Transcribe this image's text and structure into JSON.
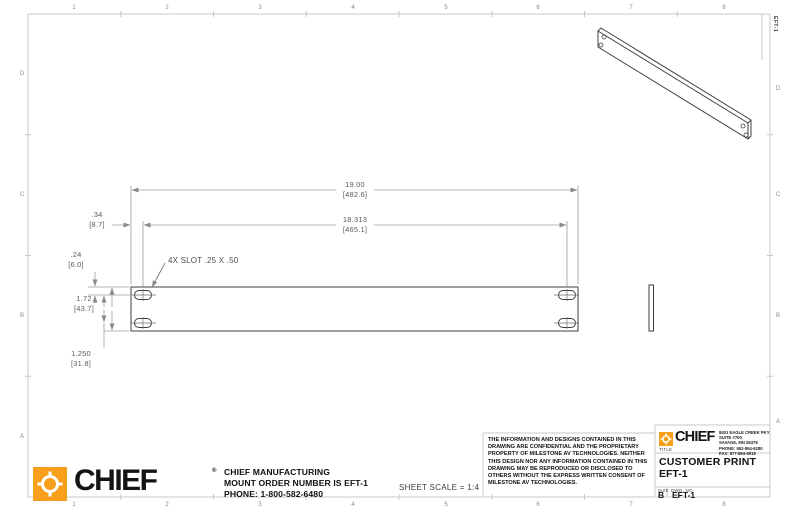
{
  "colors": {
    "chief_orange": "#F6A01C",
    "object_line": "#3f3f3f",
    "dim_line": "#9b9b9b",
    "border_line": "#c9c9c9"
  },
  "border": {
    "columns": [
      "1",
      "2",
      "3",
      "4",
      "5",
      "6",
      "7",
      "8"
    ],
    "rows": [
      "D",
      "C",
      "B",
      "A"
    ],
    "margin_drawing_number": "EFT-1"
  },
  "drawing": {
    "callout_slots": "4X SLOT .25 X .50",
    "dims": {
      "overall_width_in": "19.00",
      "overall_width_mm": "[482.6]",
      "slot_span_in": "18.313",
      "slot_span_mm": "[465.1]",
      "edge_offset_in": ".34",
      "edge_offset_mm": "[8.7]",
      "top_offset_in": ".24",
      "top_offset_mm": "[6.0]",
      "height_in": "1.72",
      "height_mm": "[43.7]",
      "row_spacing_in": "1.250",
      "row_spacing_mm": "[31.8]"
    },
    "sheet_scale": "SHEET SCALE = 1:4"
  },
  "footer": {
    "brand": "CHIEF",
    "trademark": "®",
    "company_lines": [
      "CHIEF MANUFACTURING",
      "MOUNT ORDER NUMBER IS EFT-1",
      "PHONE: 1-800-582-6480"
    ]
  },
  "legal_notice": "THE INFORMATION AND DESIGNS CONTAINED IN THIS DRAWING ARE CONFIDENTIAL AND THE PROPRIETARY PROPERTY OF MILESTONE AV TECHNOLOGIES. NEITHER THIS DESIGN NOR ANY INFORMATION CONTAINED IN THIS DRAWING MAY BE REPRODUCED OR DISCLOSED TO OTHERS WITHOUT THE EXPRESS WRITTEN CONSENT OF MILESTONE AV TECHNOLOGIES.",
  "title_block": {
    "brand": "CHIEF",
    "address_lines": [
      "8401 EAGLE CREEK PKY",
      "SUITE #700",
      "SAVAGE, MN 55378",
      "PHONE: 952-894-6280",
      "FAX: 877-894-6918"
    ],
    "title_label": "TITLE",
    "title_line1": "CUSTOMER PRINT",
    "title_line2": "EFT-1",
    "size_label": "SIZE",
    "size_value": "B",
    "dwg_label": "DWG. NO.",
    "dwg_value": "EFT-1"
  }
}
